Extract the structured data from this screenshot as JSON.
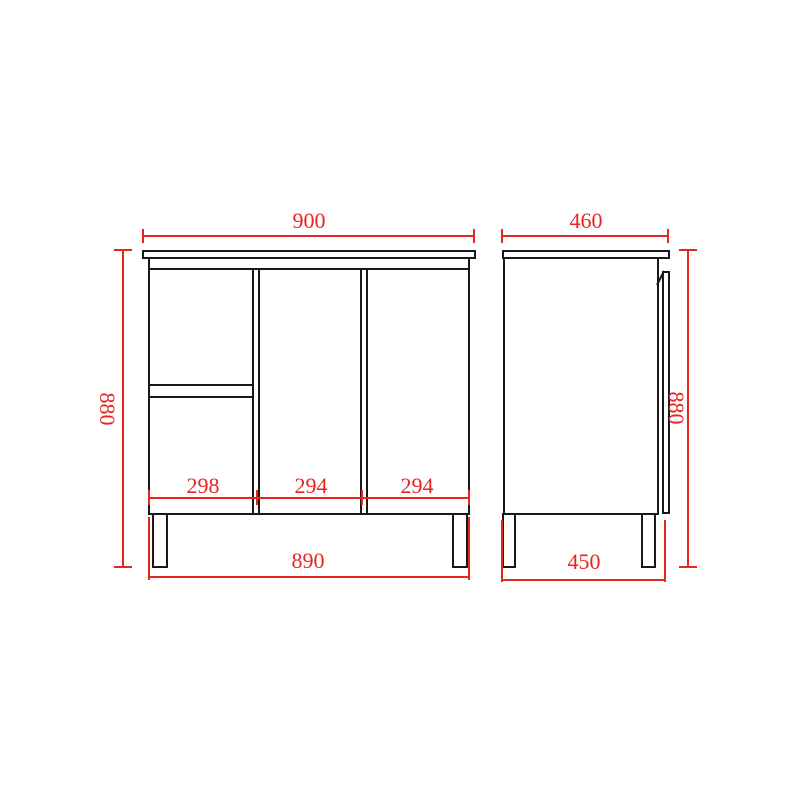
{
  "drawing": {
    "colors": {
      "outline": "#191919",
      "dimension": "#e8241f",
      "background": "#ffffff"
    },
    "front_view": {
      "width_top": "900",
      "height": "880",
      "compartments": [
        "298",
        "294",
        "294"
      ],
      "width_bottom": "890"
    },
    "side_view": {
      "depth_top": "460",
      "height": "880",
      "depth_bottom": "450"
    }
  }
}
